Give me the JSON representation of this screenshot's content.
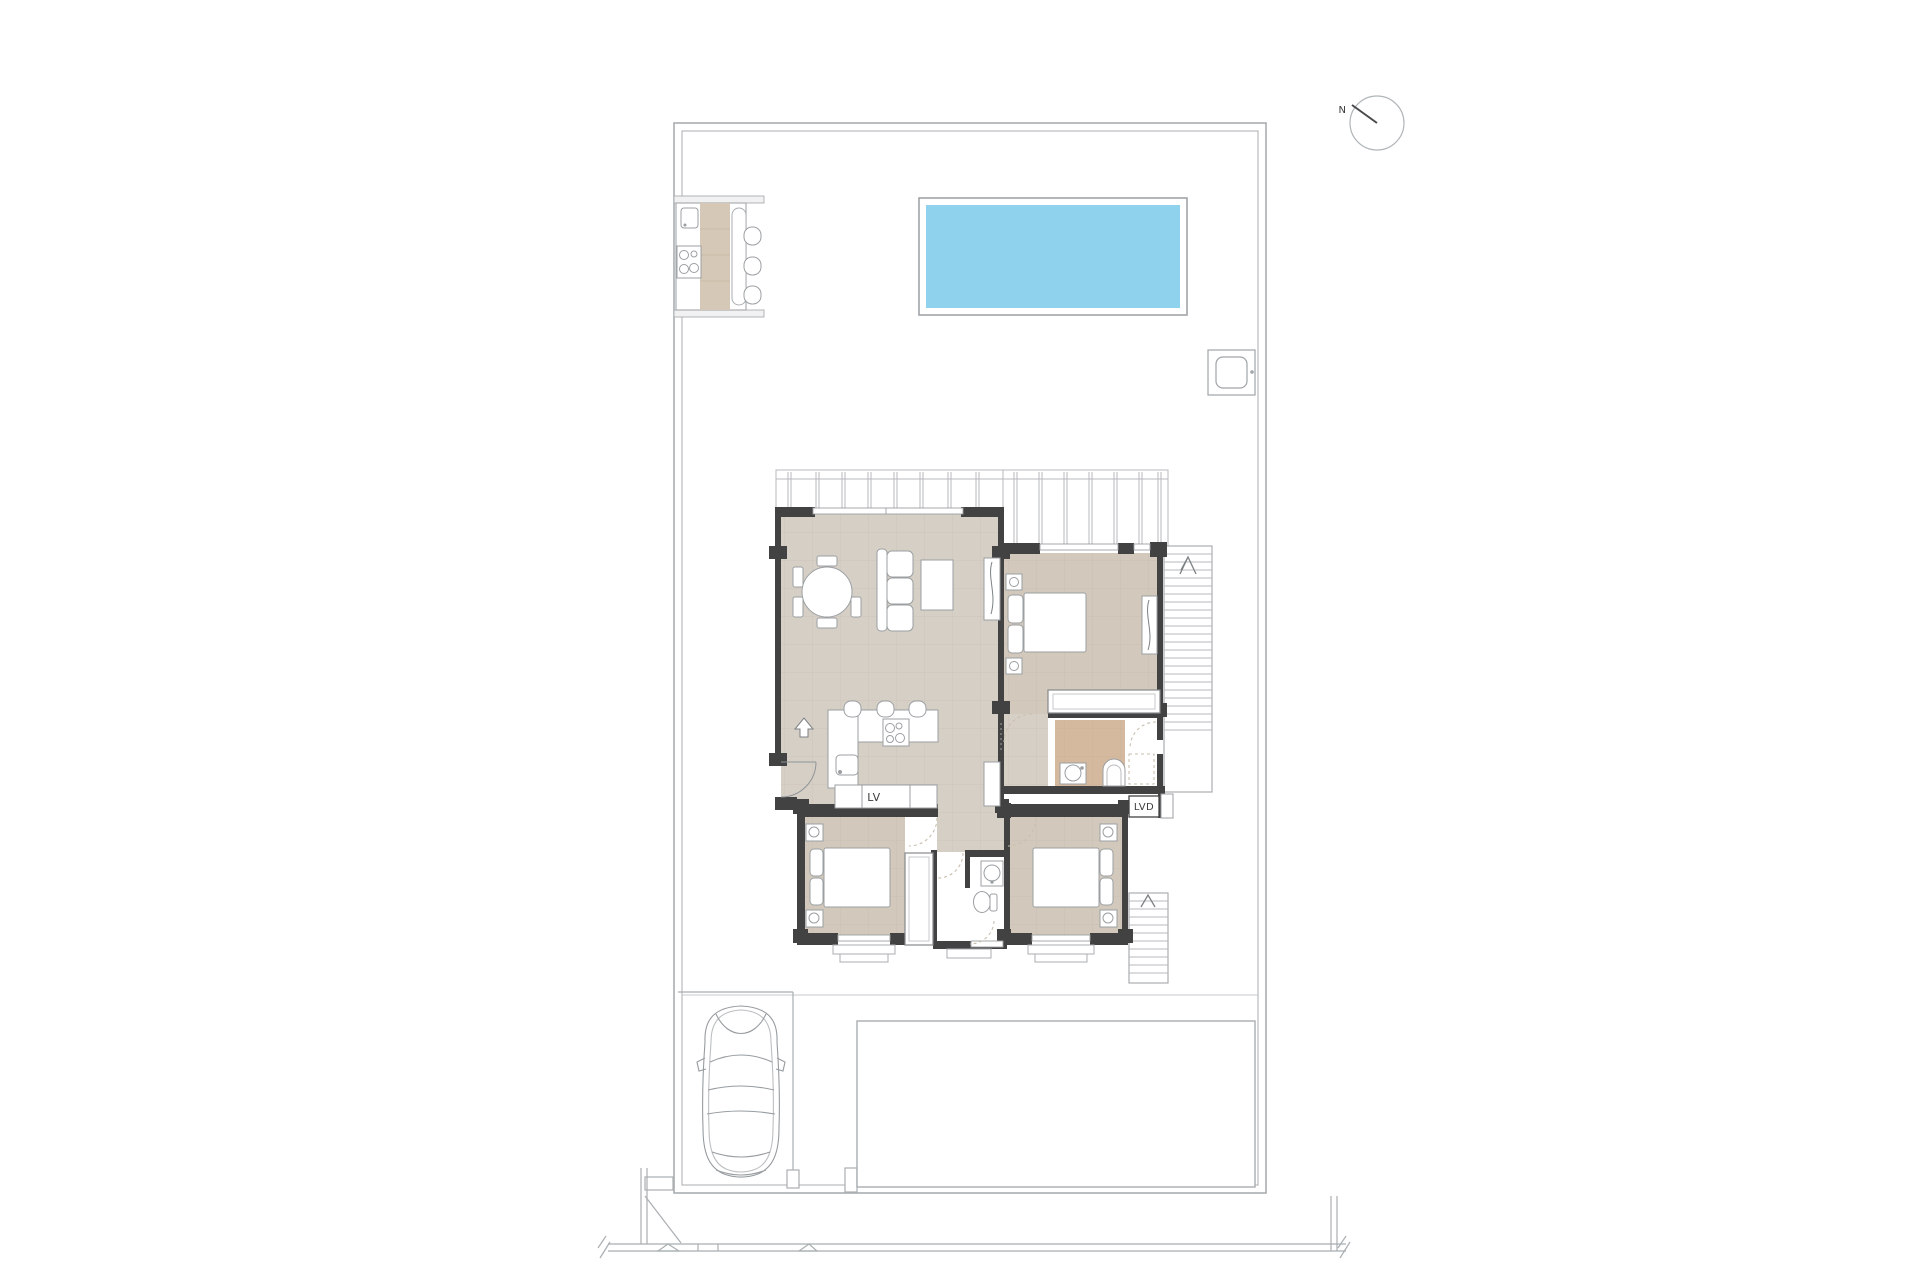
{
  "labels": {
    "north_indicator": "N",
    "dishwasher_label": "LV",
    "laundry_label": "LVD"
  },
  "colors": {
    "pool_water": "#8ed2ee",
    "floor_main": "#d6cfc6",
    "floor_bedroom": "#d2c9bc",
    "floor_bath": "#d4b99e",
    "wall": "#424242",
    "site_line": "#a9aeb1",
    "furniture_line": "#9b9fa2",
    "pergola_line": "#b5b9bc",
    "door_arc": "#c9bfae",
    "label_text": "#3c3c3c"
  }
}
